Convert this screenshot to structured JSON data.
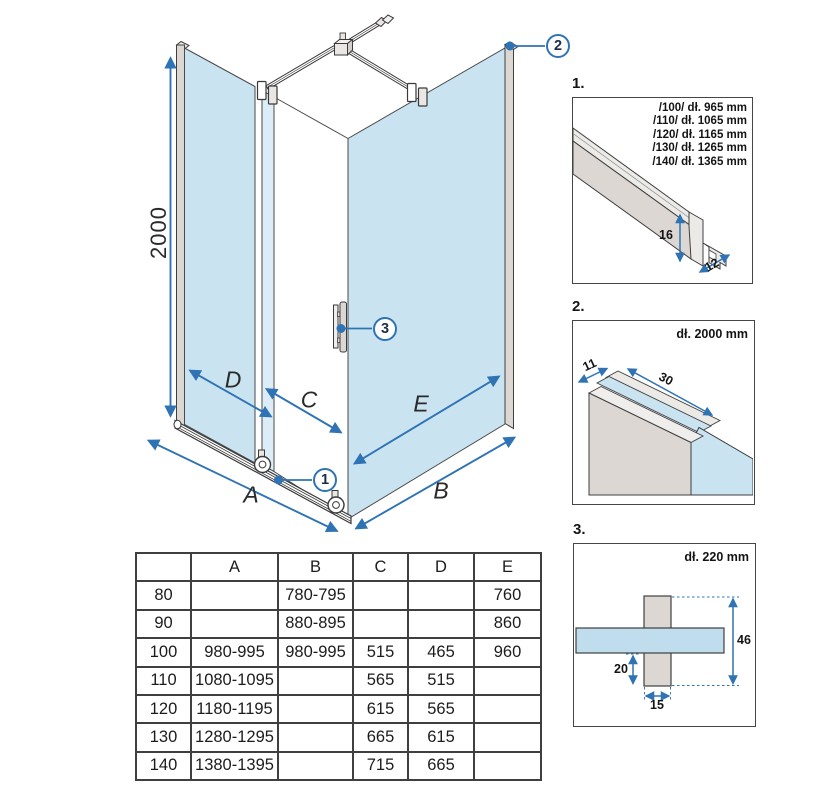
{
  "colors": {
    "glass_blue": "#c9e3f1",
    "glass_light": "#dcedf7",
    "dimension_blue": "#2f73b4",
    "profile_gray": "#dcd7d3",
    "callout_text_navy": "#1e2c45",
    "line_dark": "#3f3f3f"
  },
  "main": {
    "height_label": "2000",
    "dim_labels": {
      "d": "D",
      "c": "C",
      "e": "E",
      "a": "A",
      "b": "B"
    },
    "callouts": {
      "c1": "1",
      "c2": "2",
      "c3": "3"
    }
  },
  "details": {
    "d1": {
      "label": "1.",
      "lengths": [
        "/100/ dł. 965 mm",
        "/110/ dł. 1065 mm",
        "/120/ dł. 1165 mm",
        "/130/ dł. 1265 mm",
        "/140/ dł. 1365 mm"
      ],
      "dims": {
        "height": "16",
        "depth": "12"
      }
    },
    "d2": {
      "label": "2.",
      "length": "dł. 2000 mm",
      "dims": {
        "width": "11",
        "depth": "30"
      }
    },
    "d3": {
      "label": "3.",
      "length": "dł. 220 mm",
      "dims": {
        "height": "46",
        "offset": "20",
        "width": "15"
      }
    }
  },
  "table": {
    "headers": [
      "",
      "A",
      "B",
      "C",
      "D",
      "E"
    ],
    "rows": [
      [
        "80",
        "",
        "780-795",
        "",
        "",
        "760"
      ],
      [
        "90",
        "",
        "880-895",
        "",
        "",
        "860"
      ],
      [
        "100",
        "980-995",
        "980-995",
        "515",
        "465",
        "960"
      ],
      [
        "110",
        "1080-1095",
        "",
        "565",
        "515",
        ""
      ],
      [
        "120",
        "1180-1195",
        "",
        "615",
        "565",
        ""
      ],
      [
        "130",
        "1280-1295",
        "",
        "665",
        "615",
        ""
      ],
      [
        "140",
        "1380-1395",
        "",
        "715",
        "665",
        ""
      ]
    ]
  }
}
